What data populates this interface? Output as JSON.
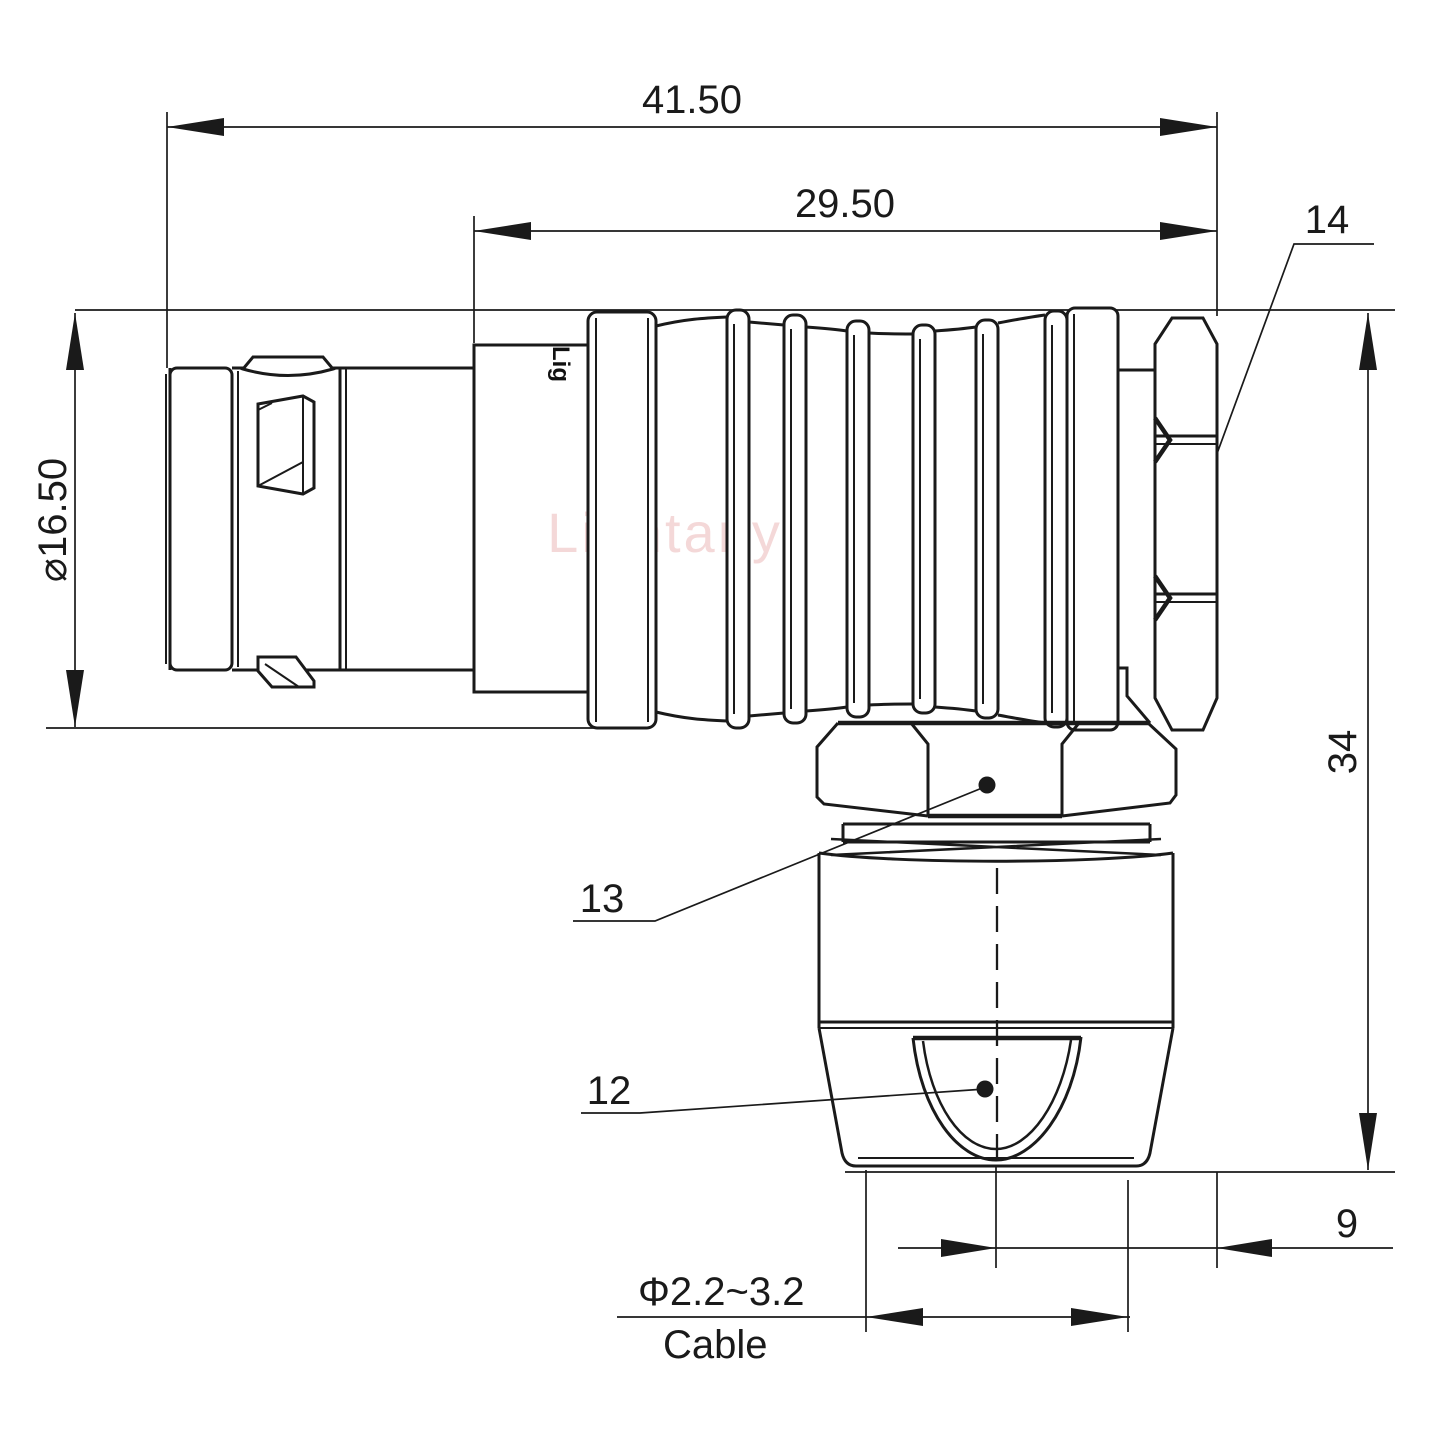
{
  "drawing": {
    "watermark": "Lightany",
    "body_logo": "Lig",
    "dimensions": {
      "overall_length": "41.50",
      "rear_length": "29.50",
      "shell_diameter": "⌀16.50",
      "overall_height": "34",
      "center_to_edge": "9",
      "cable_range": "Φ2.2~3.2",
      "cable_label": "Cable"
    },
    "part_labels": {
      "coupling_nut": "14",
      "back_nut": "13",
      "cable_gland": "12"
    },
    "colors": {
      "line": "#1a1a1a",
      "background": "#ffffff",
      "watermark": "#e08f8f"
    }
  }
}
